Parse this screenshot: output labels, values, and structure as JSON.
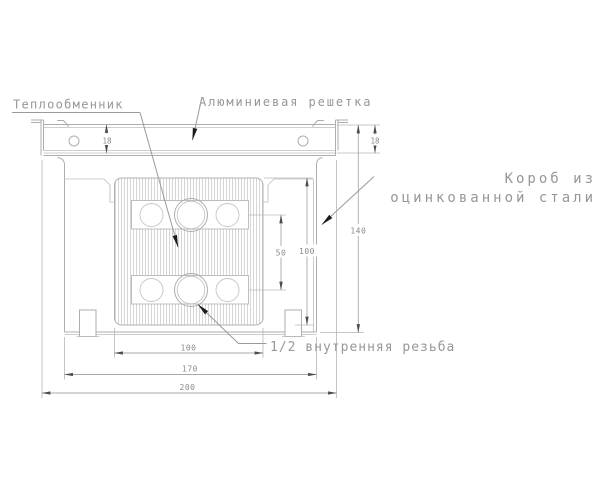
{
  "labels": {
    "heat_exchanger": "Теплообменник",
    "grille": "Алюминиевая решетка",
    "box_line1": "Короб из",
    "box_line2": "оцинкованной стали",
    "thread": "1/2 внутренняя резьба"
  },
  "dimensions": {
    "grille_height_left": "18",
    "grille_height_right": "18",
    "overall_height": "140",
    "exchanger_height": "100",
    "ports_spacing": "50",
    "exchanger_width": "100",
    "box_width": "170",
    "overall_width": "200"
  },
  "colors": {
    "drawing_line": "#aeaeae",
    "hatch": "#cccccc",
    "label_text": "#979797",
    "dim_text": "#8a8a8a",
    "leader_arrow": "#1c1c1c"
  }
}
